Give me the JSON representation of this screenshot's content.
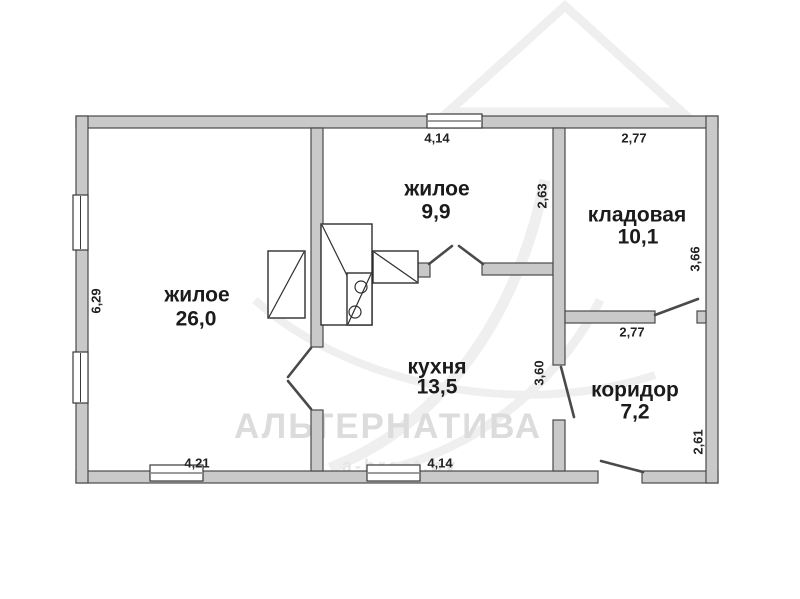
{
  "watermark": {
    "brand": "АЛЬТЕРНАТИВА",
    "site": "а-brest.by"
  },
  "colors": {
    "wall_fill": "#c9c9c9",
    "wall_stroke": "#4a4a4a",
    "label_text": "#1b1b1b",
    "watermark_text": "#dcdcdc",
    "background": "#ffffff"
  },
  "rooms": [
    {
      "name": "жилое",
      "area": "26,0"
    },
    {
      "name": "жилое",
      "area": "9,9"
    },
    {
      "name": "кладовая",
      "area": "10,1"
    },
    {
      "name": "кухня",
      "area": "13,5"
    },
    {
      "name": "коридор",
      "area": "7,2"
    }
  ],
  "dimensions": {
    "living_height": "6,29",
    "room2_width": "4,14",
    "storage_width": "2,77",
    "room2_height": "2,63",
    "storage_height": "3,66",
    "corridor_width": "2,77",
    "kitchen_height": "3,60",
    "living_width": "4,21",
    "kitchen_width": "4,14",
    "corridor_height": "2,61"
  }
}
